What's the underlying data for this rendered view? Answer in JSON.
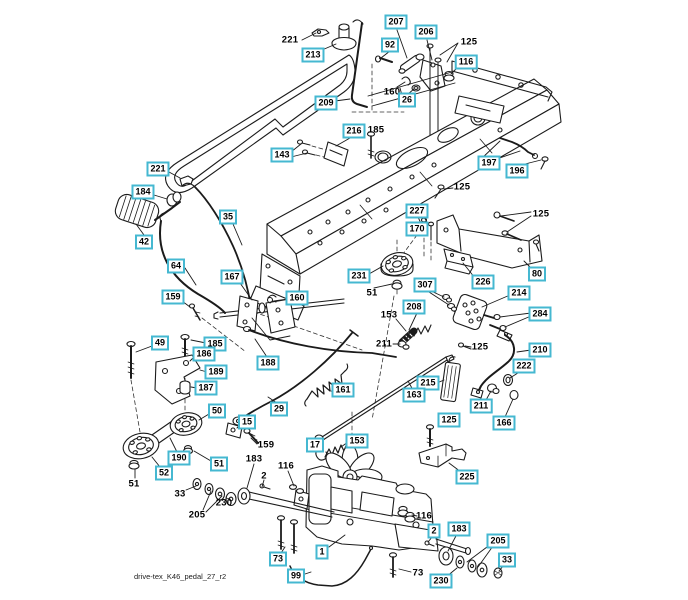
{
  "figure": {
    "footer": "drive-tex_K46_pedal_27_r2"
  },
  "colors": {
    "callout_border": "#45b8d1",
    "callout_bg": "#ffffff",
    "line": "#1b1b1b"
  },
  "labels": [
    {
      "text": "221",
      "x": 290,
      "y": 40,
      "boxed": false
    },
    {
      "text": "213",
      "x": 313,
      "y": 55,
      "boxed": true
    },
    {
      "text": "207",
      "x": 396,
      "y": 22,
      "boxed": true
    },
    {
      "text": "206",
      "x": 426,
      "y": 32,
      "boxed": true
    },
    {
      "text": "92",
      "x": 390,
      "y": 45,
      "boxed": true
    },
    {
      "text": "125",
      "x": 469,
      "y": 42,
      "boxed": false
    },
    {
      "text": "116",
      "x": 466,
      "y": 62,
      "boxed": true
    },
    {
      "text": "160",
      "x": 392,
      "y": 92,
      "boxed": false
    },
    {
      "text": "26",
      "x": 407,
      "y": 100,
      "boxed": true
    },
    {
      "text": "209",
      "x": 326,
      "y": 103,
      "boxed": true
    },
    {
      "text": "216",
      "x": 354,
      "y": 131,
      "boxed": true
    },
    {
      "text": "185",
      "x": 376,
      "y": 130,
      "boxed": false
    },
    {
      "text": "143",
      "x": 282,
      "y": 155,
      "boxed": true
    },
    {
      "text": "197",
      "x": 489,
      "y": 163,
      "boxed": true
    },
    {
      "text": "196",
      "x": 517,
      "y": 171,
      "boxed": true
    },
    {
      "text": "125",
      "x": 462,
      "y": 187,
      "boxed": false
    },
    {
      "text": "221",
      "x": 158,
      "y": 169,
      "boxed": true
    },
    {
      "text": "184",
      "x": 143,
      "y": 192,
      "boxed": true
    },
    {
      "text": "42",
      "x": 144,
      "y": 242,
      "boxed": true
    },
    {
      "text": "35",
      "x": 228,
      "y": 217,
      "boxed": true
    },
    {
      "text": "64",
      "x": 176,
      "y": 266,
      "boxed": true
    },
    {
      "text": "167",
      "x": 232,
      "y": 277,
      "boxed": true
    },
    {
      "text": "159",
      "x": 173,
      "y": 297,
      "boxed": true
    },
    {
      "text": "160",
      "x": 297,
      "y": 298,
      "boxed": true
    },
    {
      "text": "227",
      "x": 417,
      "y": 211,
      "boxed": true
    },
    {
      "text": "170",
      "x": 417,
      "y": 229,
      "boxed": true
    },
    {
      "text": "125",
      "x": 541,
      "y": 214,
      "boxed": false
    },
    {
      "text": "80",
      "x": 537,
      "y": 274,
      "boxed": true
    },
    {
      "text": "226",
      "x": 483,
      "y": 282,
      "boxed": true
    },
    {
      "text": "231",
      "x": 359,
      "y": 276,
      "boxed": true
    },
    {
      "text": "51",
      "x": 372,
      "y": 293,
      "boxed": false
    },
    {
      "text": "307",
      "x": 425,
      "y": 285,
      "boxed": true
    },
    {
      "text": "208",
      "x": 414,
      "y": 307,
      "boxed": true
    },
    {
      "text": "214",
      "x": 519,
      "y": 293,
      "boxed": true
    },
    {
      "text": "284",
      "x": 540,
      "y": 314,
      "boxed": true
    },
    {
      "text": "153",
      "x": 389,
      "y": 315,
      "boxed": false
    },
    {
      "text": "211",
      "x": 384,
      "y": 344,
      "boxed": false
    },
    {
      "text": "125",
      "x": 480,
      "y": 347,
      "boxed": false
    },
    {
      "text": "210",
      "x": 540,
      "y": 350,
      "boxed": true
    },
    {
      "text": "222",
      "x": 524,
      "y": 366,
      "boxed": true
    },
    {
      "text": "215",
      "x": 428,
      "y": 383,
      "boxed": true
    },
    {
      "text": "163",
      "x": 414,
      "y": 395,
      "boxed": true
    },
    {
      "text": "211",
      "x": 481,
      "y": 406,
      "boxed": true
    },
    {
      "text": "166",
      "x": 504,
      "y": 423,
      "boxed": true
    },
    {
      "text": "125",
      "x": 449,
      "y": 420,
      "boxed": true
    },
    {
      "text": "49",
      "x": 160,
      "y": 343,
      "boxed": true
    },
    {
      "text": "185",
      "x": 215,
      "y": 344,
      "boxed": true
    },
    {
      "text": "186",
      "x": 204,
      "y": 354,
      "boxed": true
    },
    {
      "text": "189",
      "x": 216,
      "y": 372,
      "boxed": true
    },
    {
      "text": "187",
      "x": 206,
      "y": 388,
      "boxed": true
    },
    {
      "text": "50",
      "x": 217,
      "y": 411,
      "boxed": true
    },
    {
      "text": "188",
      "x": 268,
      "y": 363,
      "boxed": true
    },
    {
      "text": "29",
      "x": 279,
      "y": 409,
      "boxed": true
    },
    {
      "text": "15",
      "x": 247,
      "y": 422,
      "boxed": true
    },
    {
      "text": "159",
      "x": 266,
      "y": 445,
      "boxed": false
    },
    {
      "text": "161",
      "x": 343,
      "y": 390,
      "boxed": true
    },
    {
      "text": "17",
      "x": 315,
      "y": 445,
      "boxed": true
    },
    {
      "text": "153",
      "x": 357,
      "y": 441,
      "boxed": true
    },
    {
      "text": "190",
      "x": 179,
      "y": 458,
      "boxed": true
    },
    {
      "text": "51",
      "x": 219,
      "y": 464,
      "boxed": true
    },
    {
      "text": "52",
      "x": 164,
      "y": 473,
      "boxed": true
    },
    {
      "text": "51",
      "x": 134,
      "y": 484,
      "boxed": false
    },
    {
      "text": "33",
      "x": 180,
      "y": 494,
      "boxed": false
    },
    {
      "text": "205",
      "x": 197,
      "y": 515,
      "boxed": false
    },
    {
      "text": "230",
      "x": 224,
      "y": 503,
      "boxed": false
    },
    {
      "text": "183",
      "x": 254,
      "y": 459,
      "boxed": false
    },
    {
      "text": "2",
      "x": 264,
      "y": 476,
      "boxed": false
    },
    {
      "text": "116",
      "x": 286,
      "y": 466,
      "boxed": false
    },
    {
      "text": "73",
      "x": 278,
      "y": 559,
      "boxed": true
    },
    {
      "text": "99",
      "x": 296,
      "y": 576,
      "boxed": true
    },
    {
      "text": "1",
      "x": 322,
      "y": 552,
      "boxed": true
    },
    {
      "text": "225",
      "x": 467,
      "y": 477,
      "boxed": true
    },
    {
      "text": "116",
      "x": 424,
      "y": 516,
      "boxed": false
    },
    {
      "text": "2",
      "x": 434,
      "y": 531,
      "boxed": true
    },
    {
      "text": "183",
      "x": 459,
      "y": 529,
      "boxed": true
    },
    {
      "text": "205",
      "x": 498,
      "y": 541,
      "boxed": true
    },
    {
      "text": "33",
      "x": 507,
      "y": 560,
      "boxed": true
    },
    {
      "text": "230",
      "x": 441,
      "y": 581,
      "boxed": true
    },
    {
      "text": "73",
      "x": 418,
      "y": 573,
      "boxed": false
    }
  ]
}
